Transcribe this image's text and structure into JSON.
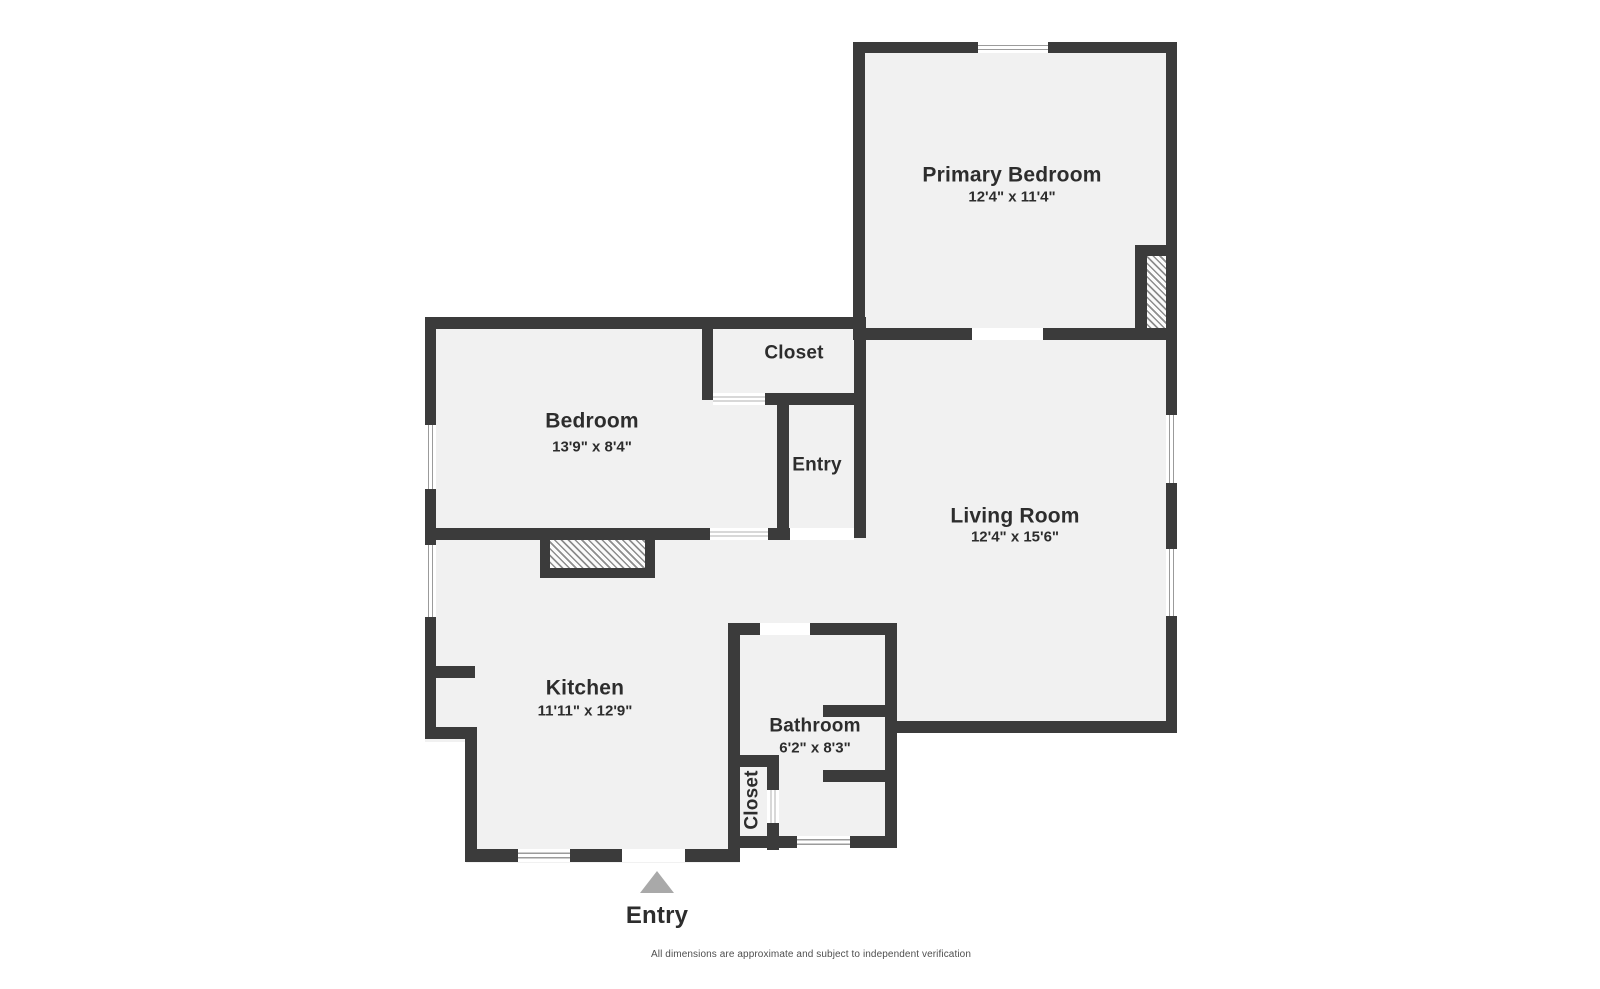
{
  "canvas": {
    "width": 1600,
    "height": 989
  },
  "colors": {
    "wall": "#3b3b3b",
    "floor": "#f1f1f1",
    "window_line": "#9b9b9b",
    "door_line": "#b0b0b0",
    "hatch_line": "#8d8d8d",
    "triangle": "#a9a9a9",
    "text": "#2d2d2d",
    "disclaimer_text": "#4f4f4f"
  },
  "labels": {
    "primary_bedroom": {
      "name": "Primary Bedroom",
      "dims": "12'4\" x 11'4\"",
      "x": 1012,
      "name_y": 175,
      "dims_y": 197
    },
    "closet_top": {
      "name": "Closet",
      "x": 794,
      "y": 353
    },
    "bedroom": {
      "name": "Bedroom",
      "dims": "13'9\" x 8'4\"",
      "x": 592,
      "name_y": 421,
      "dims_y": 447
    },
    "entry_room": {
      "name": "Entry",
      "x": 817,
      "y": 465
    },
    "living_room": {
      "name": "Living Room",
      "dims": "12'4\" x 15'6\"",
      "x": 1015,
      "name_y": 516,
      "dims_y": 537
    },
    "kitchen": {
      "name": "Kitchen",
      "dims": "11'11\" x 12'9\"",
      "x": 585,
      "name_y": 688,
      "dims_y": 711
    },
    "bathroom": {
      "name": "Bathroom",
      "dims": "6'2\" x 8'3\"",
      "x": 815,
      "name_y": 726,
      "dims_y": 748
    },
    "closet_bottom": {
      "name": "Closet",
      "x": 752,
      "y": 800
    },
    "entry_marker": {
      "name": "Entry",
      "x": 657,
      "y": 916
    }
  },
  "disclaimer": {
    "text": "All dimensions are approximate and subject to independent verification",
    "x": 811,
    "y": 955
  },
  "geometry": {
    "floors": [
      [
        853,
        42,
        324,
        298
      ],
      [
        425,
        317,
        441,
        223
      ],
      [
        425,
        540,
        315,
        202
      ],
      [
        466,
        742,
        274,
        121
      ],
      [
        866,
        328,
        311,
        405
      ],
      [
        713,
        528,
        184,
        107
      ],
      [
        728,
        623,
        169,
        225
      ]
    ],
    "walls": [
      [
        853,
        42,
        125,
        11
      ],
      [
        1048,
        42,
        129,
        11
      ],
      [
        1166,
        42,
        11,
        373
      ],
      [
        1166,
        483,
        11,
        66
      ],
      [
        1166,
        616,
        11,
        117
      ],
      [
        853,
        42,
        12,
        298
      ],
      [
        853,
        328,
        119,
        12
      ],
      [
        1043,
        328,
        134,
        12
      ],
      [
        1135,
        245,
        31,
        11
      ],
      [
        1135,
        245,
        12,
        95
      ],
      [
        425,
        317,
        441,
        12
      ],
      [
        425,
        317,
        11,
        108
      ],
      [
        425,
        489,
        11,
        56
      ],
      [
        425,
        617,
        11,
        115
      ],
      [
        702,
        317,
        11,
        83
      ],
      [
        765,
        393,
        101,
        12
      ],
      [
        777,
        393,
        12,
        137
      ],
      [
        854,
        317,
        12,
        221
      ],
      [
        425,
        528,
        285,
        12
      ],
      [
        768,
        528,
        22,
        12
      ],
      [
        540,
        540,
        10,
        38
      ],
      [
        645,
        540,
        10,
        38
      ],
      [
        540,
        568,
        115,
        10
      ],
      [
        425,
        666,
        50,
        12
      ],
      [
        425,
        727,
        52,
        12
      ],
      [
        465,
        727,
        12,
        134
      ],
      [
        465,
        849,
        53,
        13
      ],
      [
        570,
        849,
        52,
        13
      ],
      [
        685,
        849,
        55,
        13
      ],
      [
        728,
        623,
        12,
        227
      ],
      [
        728,
        623,
        32,
        12
      ],
      [
        810,
        623,
        87,
        12
      ],
      [
        885,
        623,
        12,
        225
      ],
      [
        823,
        705,
        62,
        12
      ],
      [
        823,
        770,
        62,
        12
      ],
      [
        728,
        755,
        51,
        12
      ],
      [
        767,
        755,
        12,
        35
      ],
      [
        767,
        823,
        12,
        27
      ],
      [
        728,
        836,
        69,
        12
      ],
      [
        850,
        836,
        47,
        12
      ],
      [
        885,
        721,
        292,
        12
      ]
    ],
    "windows": [
      {
        "x": 978,
        "y": 42,
        "w": 70,
        "h": 11,
        "o": "h"
      },
      {
        "x": 1166,
        "y": 415,
        "w": 11,
        "h": 68,
        "o": "v"
      },
      {
        "x": 1166,
        "y": 549,
        "w": 11,
        "h": 67,
        "o": "v"
      },
      {
        "x": 425,
        "y": 425,
        "w": 11,
        "h": 64,
        "o": "v"
      },
      {
        "x": 425,
        "y": 545,
        "w": 11,
        "h": 72,
        "o": "v"
      },
      {
        "x": 518,
        "y": 849,
        "w": 52,
        "h": 13,
        "o": "h"
      },
      {
        "x": 797,
        "y": 836,
        "w": 53,
        "h": 12,
        "o": "h"
      }
    ],
    "doors": [
      {
        "x": 713,
        "y": 393,
        "w": 52,
        "h": 12,
        "o": "h"
      },
      {
        "x": 710,
        "y": 528,
        "w": 58,
        "h": 12,
        "o": "h"
      },
      {
        "x": 767,
        "y": 790,
        "w": 12,
        "h": 33,
        "o": "v"
      }
    ],
    "openings": [
      [
        972,
        328,
        71,
        12
      ],
      [
        790,
        528,
        64,
        12
      ],
      [
        622,
        849,
        63,
        13
      ],
      [
        760,
        623,
        50,
        12
      ]
    ],
    "hatches": [
      [
        1147,
        254,
        19,
        76
      ],
      [
        550,
        540,
        95,
        28
      ]
    ],
    "triangle": {
      "x": 640,
      "y": 871,
      "w": 34,
      "h": 22
    }
  }
}
